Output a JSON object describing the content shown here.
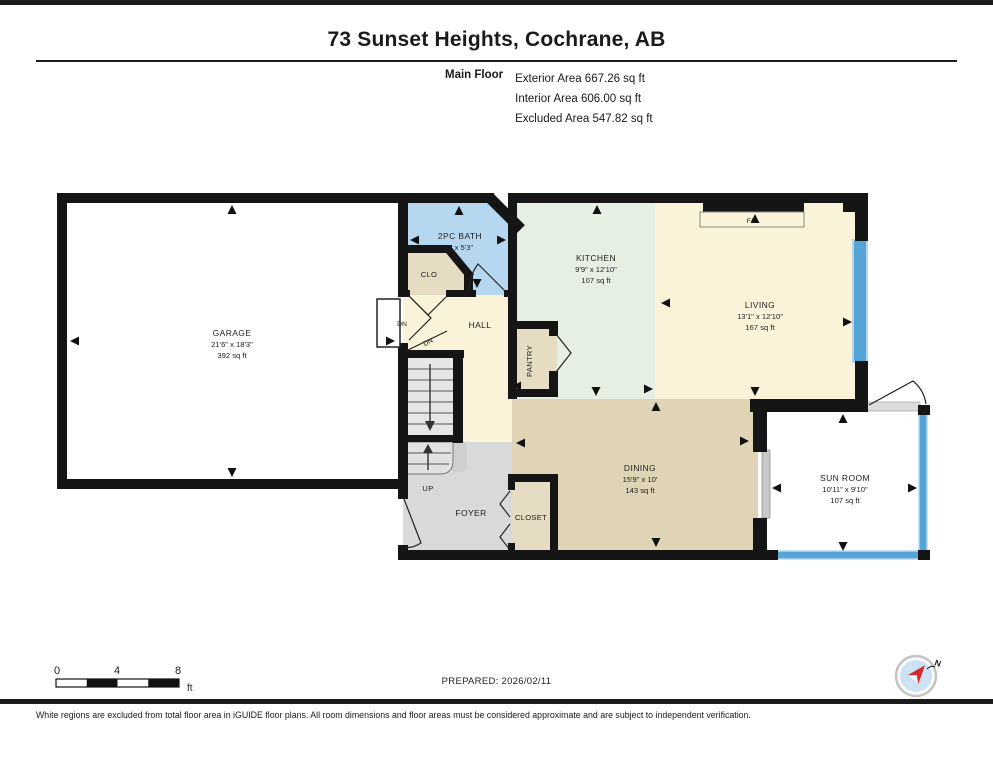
{
  "page": {
    "title": "73 Sunset Heights, Cochrane, AB",
    "floor_label": "Main Floor",
    "stats": {
      "exterior": "Exterior Area 667.26 sq ft",
      "interior": "Interior Area 606.00 sq ft",
      "excluded": "Excluded Area 547.82 sq ft"
    },
    "prepared": "PREPARED: 2026/02/11",
    "disclaimer": "White regions are excluded from total floor area in iGUIDE floor plans. All room dimensions and floor areas must be considered approximate and are subject to independent verification."
  },
  "rooms": {
    "garage": {
      "name": "GARAGE",
      "dims": "21'6\" x 18'3\"",
      "area": "392 sq ft"
    },
    "bath": {
      "name": "2PC BATH",
      "dims": "7' x 5'3\""
    },
    "clo": {
      "name": "CLO"
    },
    "hall": {
      "name": "HALL"
    },
    "kitchen": {
      "name": "KITCHEN",
      "dims": "9'9\" x 12'10\"",
      "area": "107 sq ft"
    },
    "living": {
      "name": "LIVING",
      "dims": "13'1\" x 12'10\"",
      "area": "167 sq ft"
    },
    "pantry": {
      "name": "PANTRY"
    },
    "dining": {
      "name": "DINING",
      "dims": "15'9\" x 10'",
      "area": "143 sq ft"
    },
    "sunroom": {
      "name": "SUN ROOM",
      "dims": "10'11\" x 9'10\"",
      "area": "107 sq ft"
    },
    "foyer": {
      "name": "FOYER"
    },
    "closet": {
      "name": "CLOSET"
    },
    "fireplace": {
      "name": "F/P"
    }
  },
  "annotations": {
    "up": "UP",
    "dn_garage": "DN",
    "dn_stairs": "DN"
  },
  "scale_bar": {
    "tick0": "0",
    "tick4": "4",
    "tick8": "8",
    "unit": "ft"
  },
  "compass": {
    "north": "N"
  },
  "colors": {
    "wall": "#151515",
    "bath_blue": "#b5d8f0",
    "closet_tan": "#e6dcc4",
    "cream": "#faf3d9",
    "kitchen_mint": "#e5efe2",
    "dining_tan": "#e0d4b6",
    "foyer_gray": "#d9d9d9",
    "window_blue": "#55a4d8"
  }
}
